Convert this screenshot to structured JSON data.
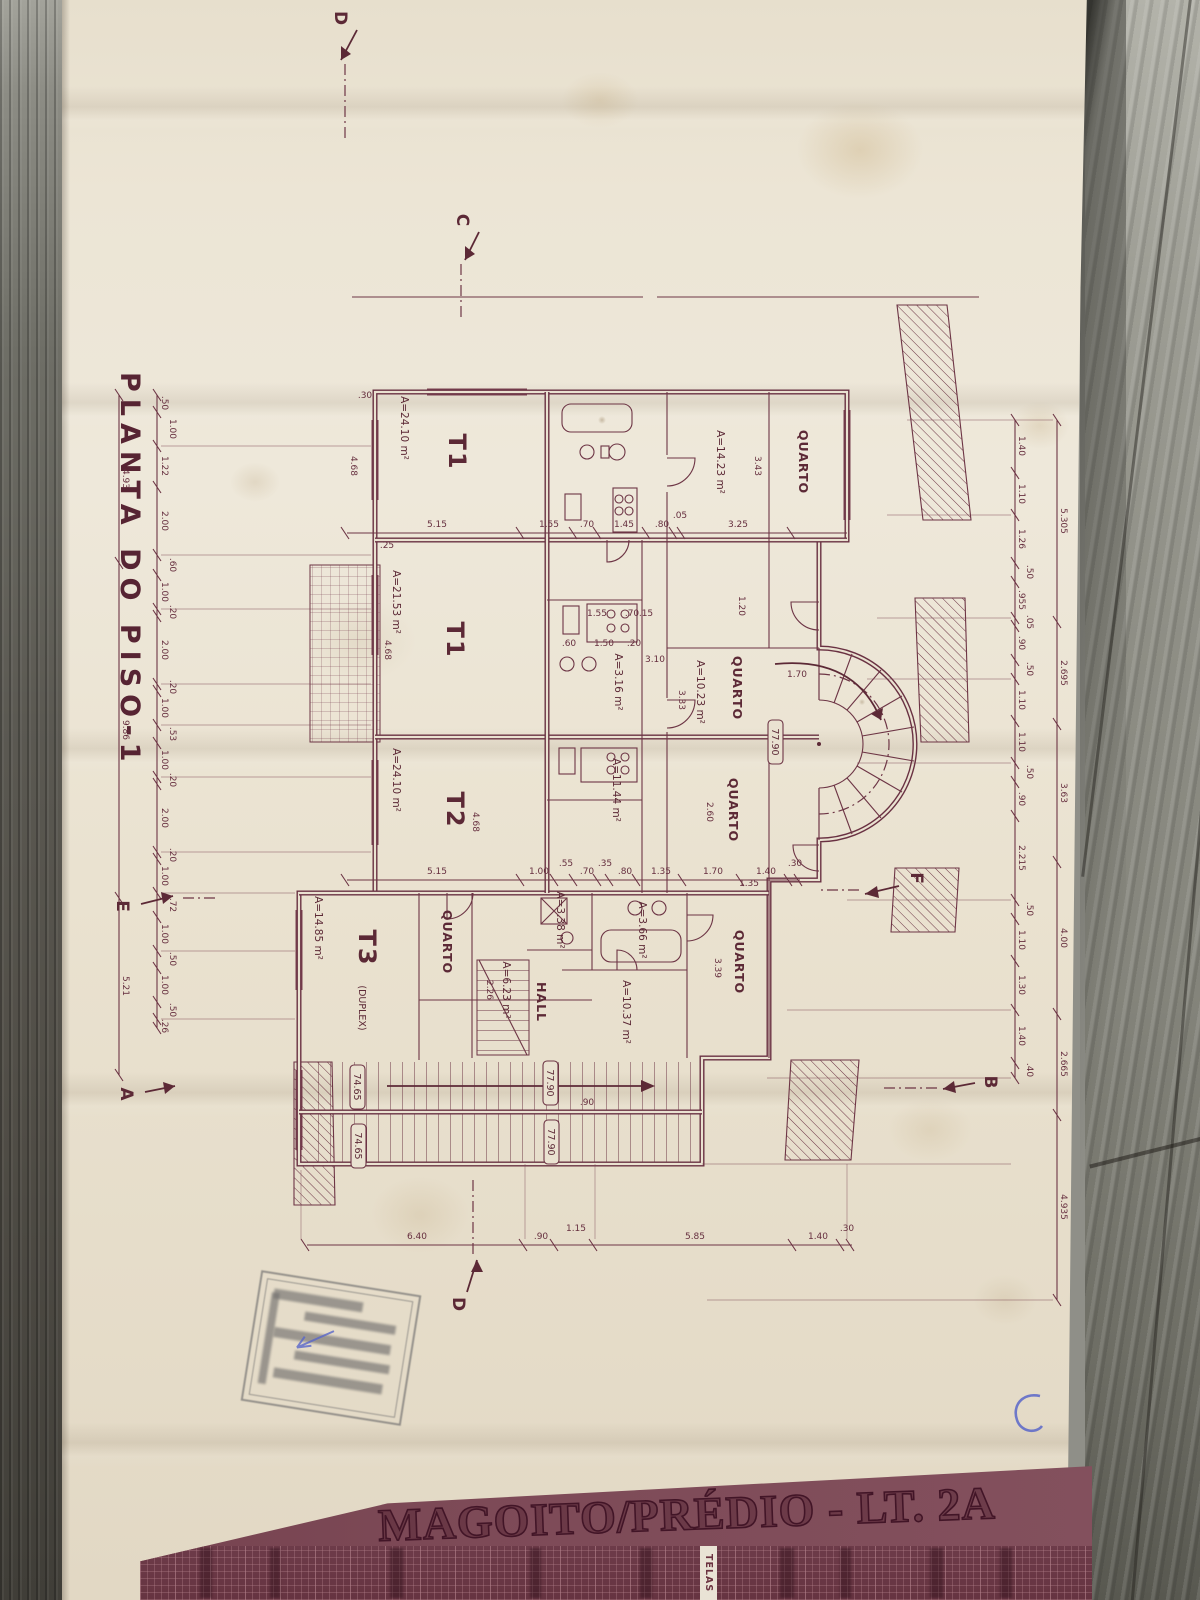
{
  "colors": {
    "ink": "#5f2b3a",
    "paper": "#eae2d1",
    "banner_bg": "#7d4a57",
    "wood": "#8f8f88",
    "stamp_ink": "#70706e",
    "pen_blue": "#5966c9"
  },
  "title": "PLANTA DO PISO-1",
  "sections": {
    "a": "A",
    "b": "B",
    "c": "C",
    "d": "D",
    "e": "E",
    "f": "F"
  },
  "units": [
    {
      "label": "T1",
      "area": "A=24.10 m²"
    },
    {
      "label": "T1",
      "area": "A=21.53 m²"
    },
    {
      "label": "T2",
      "area": "A=24.10 m²"
    },
    {
      "label": "T3",
      "sub": "(DUPLEX)",
      "area": "A=14.85 m²"
    }
  ],
  "rooms": {
    "quarto": "QUARTO",
    "hall": "HALL",
    "areas": [
      "A=14.23 m²",
      "A=10.23 m²",
      "A=11.44 m²",
      "A=3.16 m²",
      "A=3.66 m²",
      "A=10.37 m²",
      "A=3.38 m²",
      "A=6.23 m²"
    ]
  },
  "elevations": {
    "upper": "77.90",
    "lower": "74.65"
  },
  "dims": {
    "left_chain": [
      ".50",
      "1.00",
      "1.22",
      "2.00",
      ".60",
      "1.00",
      ".20",
      "2.00",
      ".20",
      "1.00",
      ".53",
      "1.00",
      ".20",
      "2.00",
      ".20",
      "1.00",
      ".72",
      "1.00",
      ".50",
      "1.00",
      ".50",
      ".26"
    ],
    "left_totals": [
      "4.93",
      "9.86",
      "5.21"
    ],
    "right_chain": [
      "1.40",
      "1.10",
      "1.26",
      ".50",
      ".955",
      ".05",
      ".90",
      ".50",
      "1.10",
      "1.10",
      ".50",
      ".90",
      "2.215",
      ".50",
      "1.10",
      "1.30",
      "1.40",
      ".40"
    ],
    "right_totals": [
      "5.305",
      "2.695",
      "3.63",
      "4.00",
      "2.665",
      "4.935"
    ],
    "row_top": [
      "5.15",
      "1.55",
      ".70",
      "1.45",
      ".80",
      ".05",
      "3.25"
    ],
    "row_mid": [
      "5.15",
      "1.00",
      ".55",
      ".70",
      ".35",
      ".80",
      "1.35",
      "1.70",
      "1.40",
      ".30"
    ],
    "row_bottom": [
      "6.40",
      ".90",
      "1.15",
      "5.85",
      "1.40",
      ".30"
    ],
    "kitchen": [
      "1.55",
      ".70",
      ".15",
      ".60",
      "1.50",
      ".20"
    ],
    "misc": [
      "3.43",
      "3.33",
      "2.60",
      "3.39",
      "3.10",
      "1.20",
      "4.68",
      "4.68",
      "4.68",
      "2.26",
      ".25",
      ".30",
      ".90",
      "1.70",
      "1.35"
    ]
  },
  "banner": {
    "title": "MAGOITO/PRÉDIO - LT. 2A",
    "tag": "TELAS"
  }
}
